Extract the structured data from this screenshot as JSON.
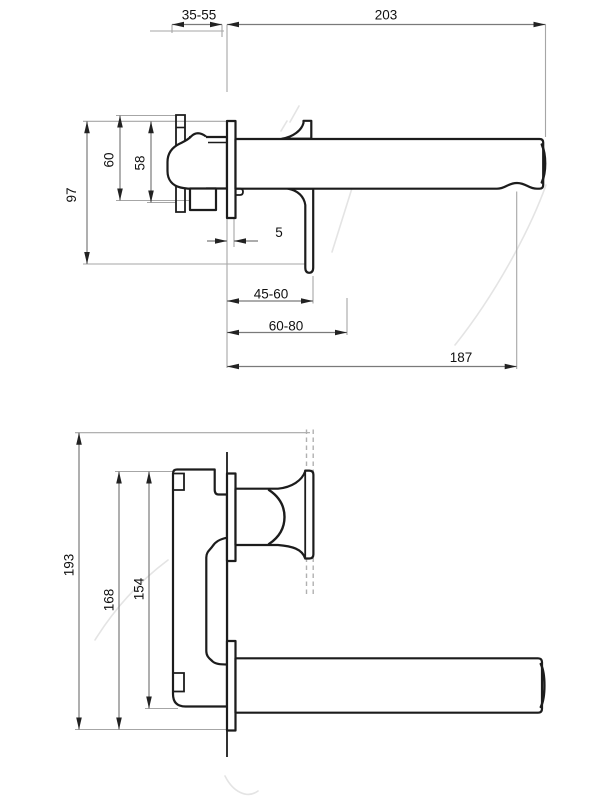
{
  "colors": {
    "background": "#ffffff",
    "line": "#1c1c1c",
    "dim": "#7a7a7a",
    "ext": "#a6a6a6",
    "text": "#111111",
    "dashed": "#b0b0b0",
    "watermark": "#e4e4e4"
  },
  "views": {
    "side_view": {
      "name": "wall-mounted mixer side elevation",
      "dimensions": {
        "wall_depth_range": "35-55",
        "spout_total_length": "203",
        "body_height_outer": "60",
        "body_height_inner": "58",
        "total_height": "97",
        "plate_thickness": "5",
        "handle_reach_range": "45-60",
        "handle_reach_max_range": "60-80",
        "spout_reach_to_aerator": "187"
      }
    },
    "front_view": {
      "name": "wall-mounted mixer front elevation",
      "dimensions": {
        "total_height": "193",
        "body_height": "168",
        "body_inner_height": "154"
      }
    }
  }
}
